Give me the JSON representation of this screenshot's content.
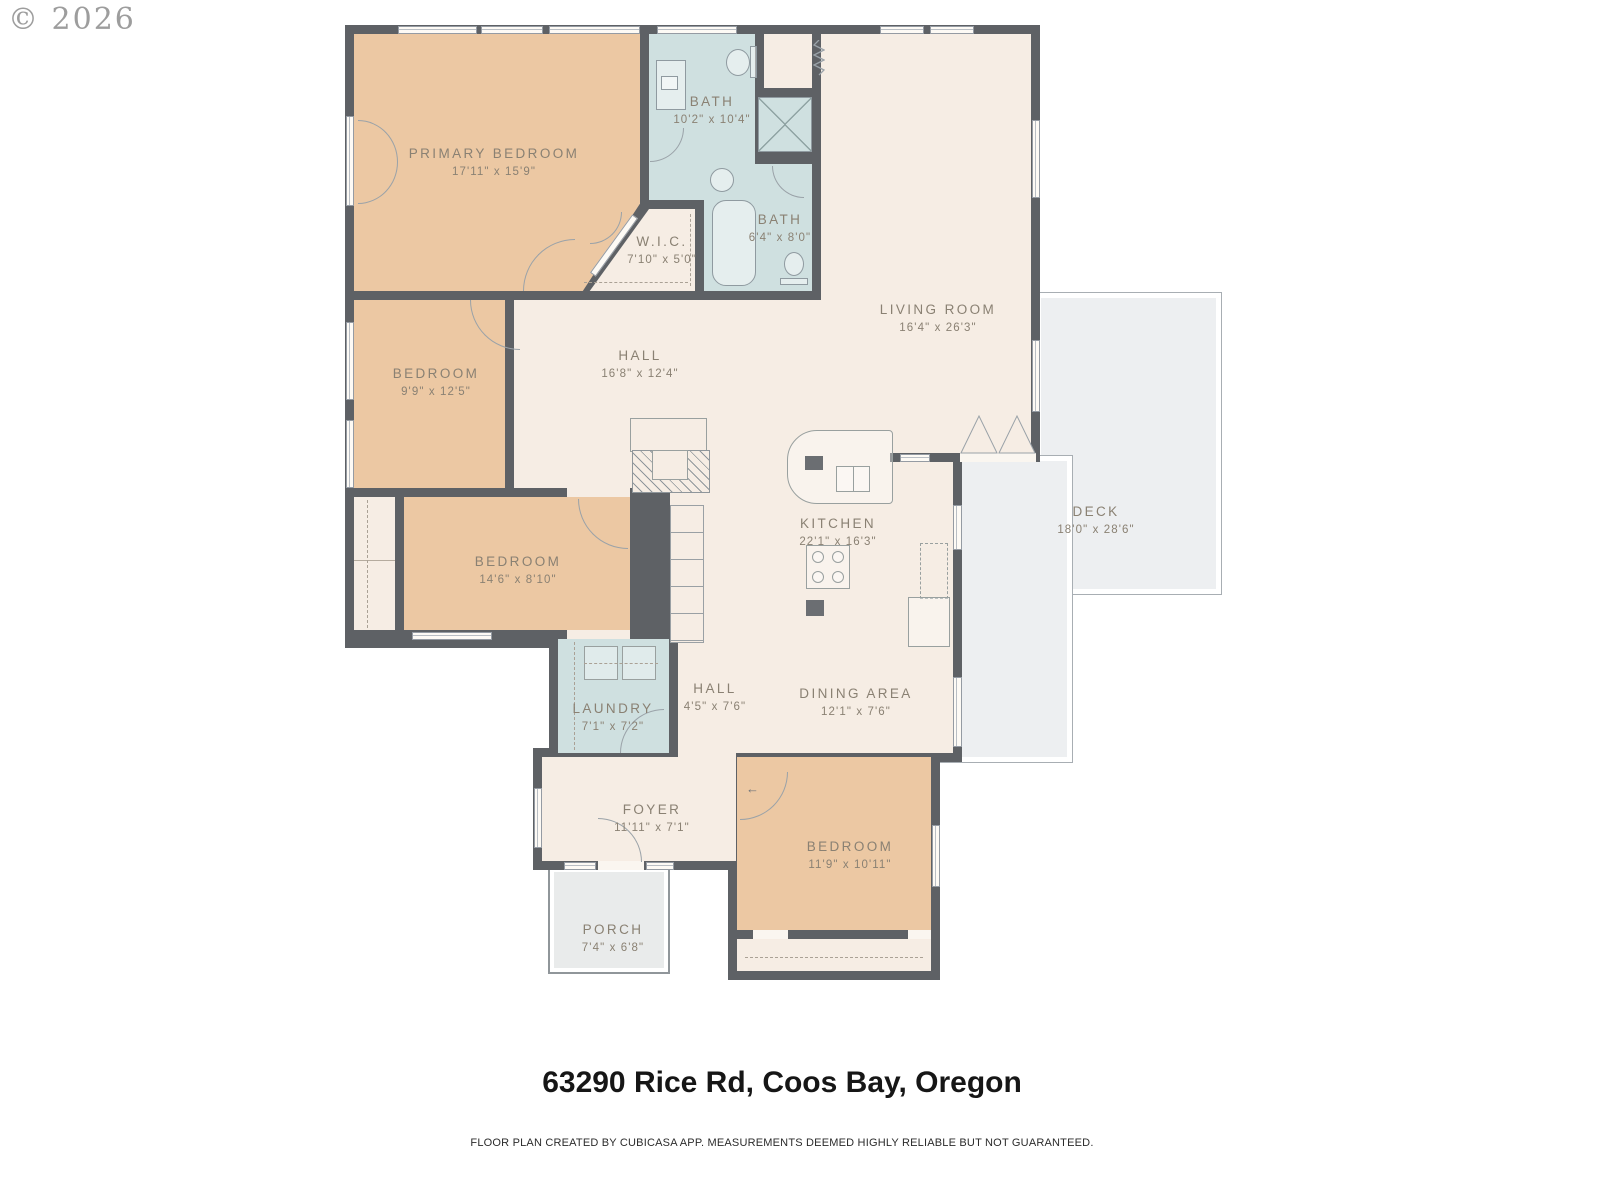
{
  "copyright": "© 2026",
  "footer": {
    "address": "63290 Rice Rd, Coos Bay, Oregon",
    "disclaimer": "FLOOR PLAN CREATED BY CUBICASA APP. MEASUREMENTS DEEMED HIGHLY RELIABLE BUT NOT GUARANTEED."
  },
  "colors": {
    "wall": "#5e6165",
    "interior": "#f6ede4",
    "bedroom": "#ecc8a3",
    "bath": "#cfe0e0",
    "deck": "#edeff1",
    "porch": "#e9ebeb",
    "label_text": "#8a8173",
    "fixture_line": "#8f9aa0"
  },
  "rooms": [
    {
      "key": "primary-bedroom",
      "name": "PRIMARY BEDROOM",
      "dims": "17'11\" x 15'9\""
    },
    {
      "key": "bath-main",
      "name": "BATH",
      "dims": "10'2\" x 10'4\""
    },
    {
      "key": "bath-second",
      "name": "BATH",
      "dims": "6'4\" x 8'0\""
    },
    {
      "key": "walk-in-closet",
      "name": "W.I.C.",
      "dims": "7'10\" x 5'0\""
    },
    {
      "key": "living-room",
      "name": "LIVING ROOM",
      "dims": "16'4\" x 26'3\""
    },
    {
      "key": "hall-upper",
      "name": "HALL",
      "dims": "16'8\" x 12'4\""
    },
    {
      "key": "bedroom-2",
      "name": "BEDROOM",
      "dims": "9'9\" x 12'5\""
    },
    {
      "key": "kitchen",
      "name": "KITCHEN",
      "dims": "22'1\" x 16'3\""
    },
    {
      "key": "deck",
      "name": "DECK",
      "dims": "18'0\" x 28'6\""
    },
    {
      "key": "bedroom-3",
      "name": "BEDROOM",
      "dims": "14'6\" x 8'10\""
    },
    {
      "key": "laundry",
      "name": "LAUNDRY",
      "dims": "7'1\" x 7'2\""
    },
    {
      "key": "hall-lower",
      "name": "HALL",
      "dims": "4'5\" x 7'6\""
    },
    {
      "key": "dining-area",
      "name": "DINING AREA",
      "dims": "12'1\" x 7'6\""
    },
    {
      "key": "foyer",
      "name": "FOYER",
      "dims": "11'11\" x 7'1\""
    },
    {
      "key": "bedroom-4",
      "name": "BEDROOM",
      "dims": "11'9\" x 10'11\""
    },
    {
      "key": "porch",
      "name": "PORCH",
      "dims": "7'4\" x 6'8\""
    }
  ],
  "icons": [
    "window",
    "door-arc",
    "french-doors-icon",
    "toilet-icon",
    "sink-icon",
    "vanity-icon",
    "bathtub-icon",
    "shower-icon",
    "washer-icon",
    "dryer-icon",
    "kitchen-island-icon",
    "kitchen-sink-icon",
    "stove-icon",
    "fridge-icon",
    "counter-icon",
    "fireplace-icon",
    "shelves-icon",
    "water-heater-icon",
    "entry-arrow-icon",
    "pocket-door-icon"
  ]
}
